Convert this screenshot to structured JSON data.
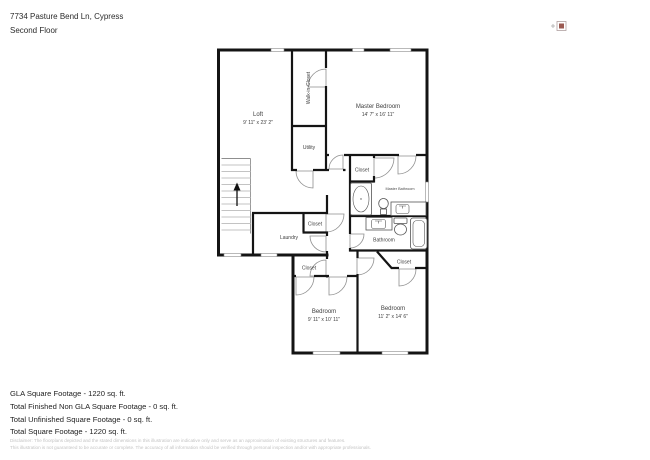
{
  "header": {
    "address": "7734 Pasture Bend Ln, Cypress",
    "floor_label": "Second Floor"
  },
  "plan": {
    "rooms": {
      "loft": {
        "label": "Loft",
        "dims": "9' 11\" x 23' 2\""
      },
      "walk_in_closet": {
        "label": "Walk-in-Closet"
      },
      "master_bedroom": {
        "label": "Master Bedroom",
        "dims": "14' 7\" x 16' 11\""
      },
      "utility": {
        "label": "Utility"
      },
      "master_closet": {
        "label": "Closet"
      },
      "master_bathroom": {
        "label": "Master Bathroom"
      },
      "laundry": {
        "label": "Laundry"
      },
      "laundry_closet": {
        "label": "Closet"
      },
      "bathroom": {
        "label": "Bathroom"
      },
      "hall_closet": {
        "label": "Closet"
      },
      "bedroom_right_closet": {
        "label": "Closet"
      },
      "bedroom_left": {
        "label": "Bedroom",
        "dims": "9' 11\" x 10' 11\""
      },
      "bedroom_right": {
        "label": "Bedroom",
        "dims": "11' 2\" x 14' 6\""
      }
    }
  },
  "footer": {
    "summary_lines": [
      "GLA Square Footage - 1220 sq. ft.",
      "Total Finished Non GLA Square Footage - 0 sq. ft.",
      "Total Unfinished Square Footage - 0 sq. ft.",
      "Total Square Footage - 1220 sq. ft."
    ],
    "disclaimer_line1": "Disclaimer: The floorplans depicted and the stated dimensions in this illustration are indicative only and serve as an approximation of existing structures and features.",
    "disclaimer_line2": "This illustration is not guaranteed to be accurate or complete. The accuracy of all information should be verified through personal inspection and/or with appropriate professionals."
  }
}
